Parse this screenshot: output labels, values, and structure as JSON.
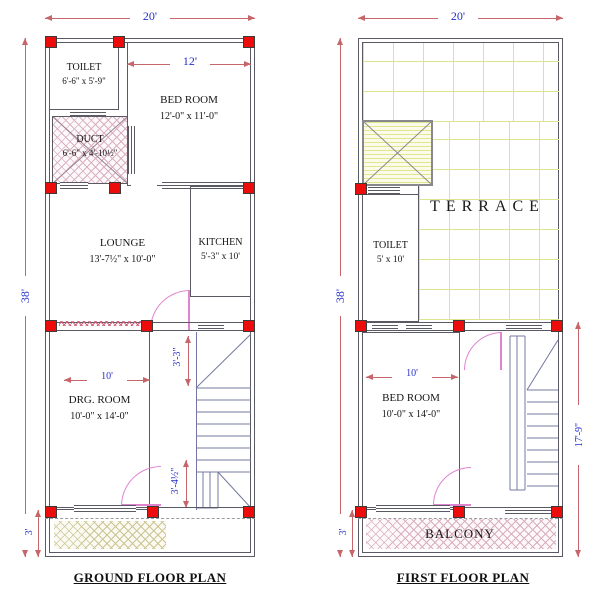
{
  "drawing": {
    "type": "architectural-floor-plan"
  },
  "colors": {
    "column_red": "#ed0c0c",
    "dimension_text": "#2630c8",
    "dimension_line": "#c6666a",
    "door_pink": "#df85cf",
    "wall_gray": "#5a5a64",
    "terrace_grid": "#dde48e"
  },
  "ground_floor": {
    "title": "GROUND FLOOR PLAN",
    "rooms": {
      "toilet": {
        "name": "TOILET",
        "size": "6'-6\" x 5'-9\""
      },
      "duct": {
        "name": "DUCT",
        "size": "6'-6\" x 4'-10½\""
      },
      "bedroom": {
        "name": "BED ROOM",
        "size": "12'-0\" x 11'-0\""
      },
      "lounge": {
        "name": "LOUNGE",
        "size": "13'-7½\" x 10'-0\""
      },
      "kitchen": {
        "name": "KITCHEN",
        "size": "5'-3\" x 10'"
      },
      "drg_room": {
        "name": "DRG. ROOM",
        "size": "10'-0\" x 14'-0\""
      }
    },
    "dimensions": {
      "width_top": "20'",
      "height_left": "38'",
      "porch_height": "3'",
      "bedroom_width": "12'",
      "drg_width": "10'",
      "stair_upper": "3'-3\"",
      "stair_lower": "3'-4½\""
    }
  },
  "first_floor": {
    "title": "FIRST FLOOR PLAN",
    "rooms": {
      "terrace": {
        "name": "TERRACE"
      },
      "toilet": {
        "name": "TOILET",
        "size": "5' x  10'"
      },
      "bedroom": {
        "name": "BED ROOM",
        "size": "10'-0\" x 14'-0\""
      },
      "balcony": {
        "name": "BALCONY"
      }
    },
    "dimensions": {
      "width_top": "20'",
      "height_left": "38'",
      "balcony_height": "3'",
      "bedroom_width": "10'",
      "stair_height_right": "17'-9\""
    }
  }
}
